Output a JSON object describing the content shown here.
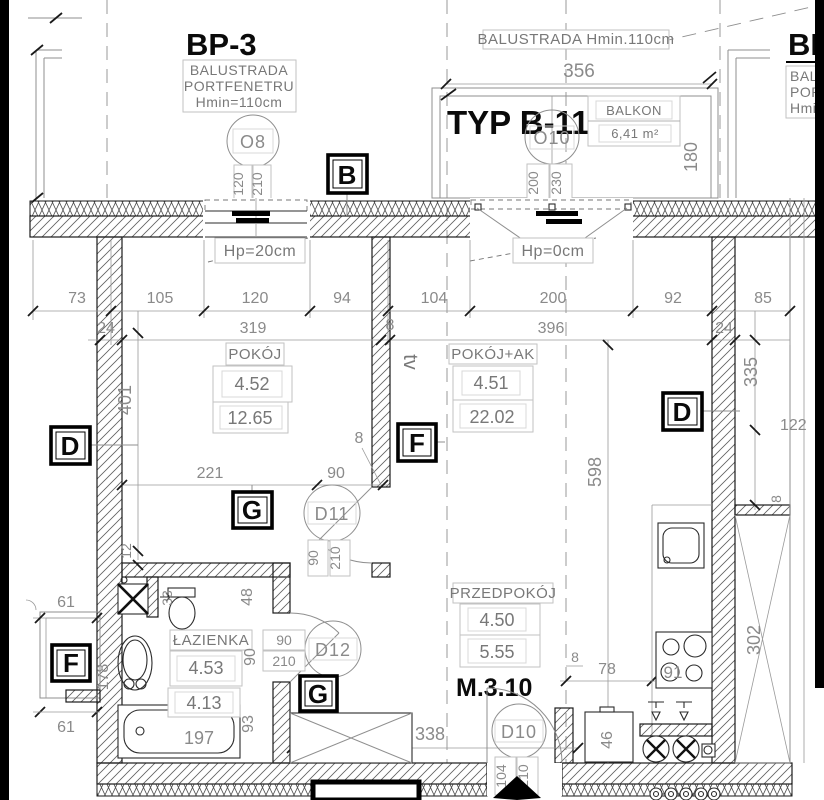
{
  "plan": {
    "apartment_no": "M.3.10",
    "type_label": "TYP B-11",
    "bp3": {
      "title": "BP-3",
      "line1": "BALUSTRADA",
      "line2": "PORTFENETRU",
      "line3": "Hmin=110cm"
    },
    "bp_right": {
      "title": "BP",
      "line1": "BALU",
      "line2": "PORT",
      "line3": "Hmin"
    },
    "balcony": {
      "balustrade": "BALUSTRADA  Hmin.110cm",
      "name": "BALKON",
      "area": "6,41  m²",
      "width": "356",
      "depth": "180"
    },
    "windows": {
      "o8": {
        "id": "O8",
        "w": "120",
        "h": "210",
        "hp": "Hp=20cm"
      },
      "o10": {
        "id": "O10",
        "w": "200",
        "h": "230",
        "hp": "Hp=0cm"
      }
    },
    "doors": {
      "d10": {
        "id": "D10",
        "w": "104",
        "h": "210"
      },
      "d11": {
        "id": "D11",
        "w": "90",
        "h": "210"
      },
      "d12": {
        "id": "D12",
        "w": "90",
        "h": "210"
      }
    },
    "rooms": {
      "pokoj": {
        "name": "POKÓJ",
        "no": "4.52",
        "area": "12.65"
      },
      "pokoj_ak": {
        "name": "POKÓJ+AK",
        "no": "4.51",
        "area": "22.02"
      },
      "lazienka": {
        "name": "ŁAZIENKA",
        "no": "4.53",
        "area": "4.13"
      },
      "przedpokoj": {
        "name": "PRZEDPOKÓJ",
        "no": "4.50",
        "area": "5.55"
      }
    },
    "markers": {
      "b": "B",
      "d": "D",
      "f": "F",
      "g": "G"
    },
    "furniture": {
      "tv": "tv"
    },
    "dims": {
      "row1": [
        "73",
        "105",
        "120",
        "94",
        "104",
        "200",
        "92",
        "85"
      ],
      "row2": [
        "24",
        "319",
        "8",
        "396",
        "24"
      ],
      "v401": "401",
      "v12": "12",
      "v598": "598",
      "v335": "335",
      "h122": "122",
      "v302": "302",
      "r8": "8",
      "d221": "221",
      "d90": "90",
      "d8": "8",
      "d61a": "61",
      "d61b": "61",
      "v178": "178",
      "d197": "197",
      "v93": "93",
      "v90": "90",
      "v48": "48",
      "v33": "33",
      "d338": "338",
      "d78": "78",
      "d8b": "8",
      "v46": "46",
      "d91": "91"
    }
  }
}
